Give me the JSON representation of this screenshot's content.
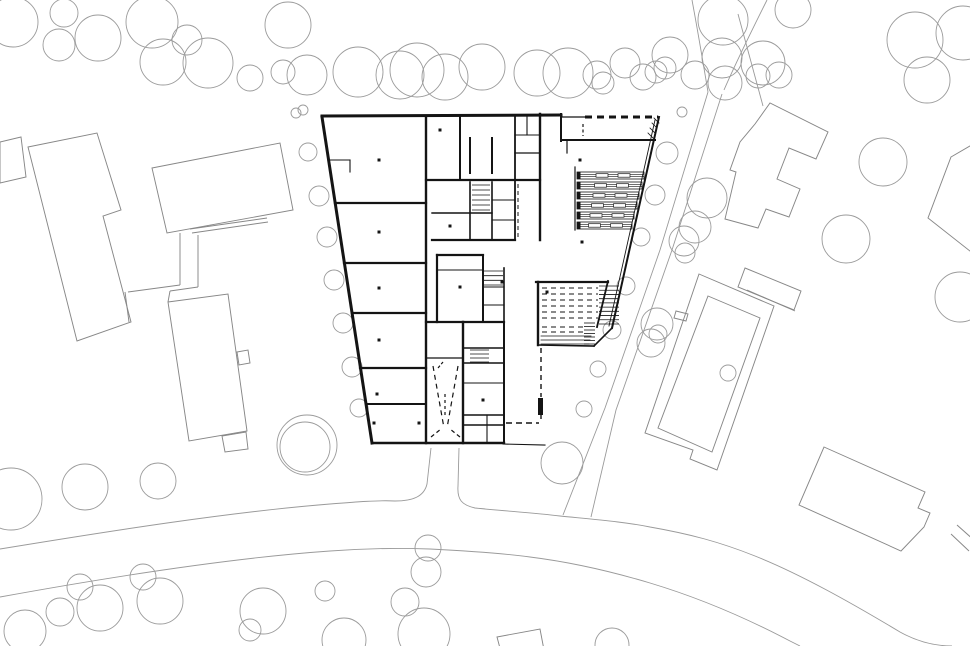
{
  "canvas": {
    "w": 970,
    "h": 646,
    "bg": "#ffffff"
  },
  "style": {
    "tree_stroke": "#9b9b9b",
    "tree_width": 0.9,
    "context_stroke": "#878787",
    "context_width": 0.95,
    "road_stroke": "#9a9a9a",
    "road_width": 0.9,
    "wall_color": "#141414"
  },
  "trees": [
    [
      13,
      22,
      25
    ],
    [
      64,
      13,
      14
    ],
    [
      59,
      45,
      16
    ],
    [
      98,
      38,
      23
    ],
    [
      152,
      22,
      26
    ],
    [
      163,
      62,
      23
    ],
    [
      187,
      40,
      15
    ],
    [
      208,
      63,
      25
    ],
    [
      250,
      78,
      13
    ],
    [
      288,
      25,
      23
    ],
    [
      283,
      72,
      12
    ],
    [
      307,
      75,
      20
    ],
    [
      303,
      110,
      5
    ],
    [
      358,
      72,
      25
    ],
    [
      400,
      75,
      24
    ],
    [
      417,
      70,
      27
    ],
    [
      445,
      77,
      23
    ],
    [
      482,
      67,
      23
    ],
    [
      537,
      73,
      23
    ],
    [
      568,
      73,
      25
    ],
    [
      597,
      75,
      14
    ],
    [
      603,
      83,
      11
    ],
    [
      625,
      63,
      15
    ],
    [
      643,
      77,
      13
    ],
    [
      656,
      72,
      11
    ],
    [
      670,
      55,
      18
    ],
    [
      665,
      68,
      11
    ],
    [
      695,
      75,
      14
    ],
    [
      723,
      20,
      25
    ],
    [
      722,
      58,
      20
    ],
    [
      725,
      83,
      17
    ],
    [
      763,
      63,
      22
    ],
    [
      758,
      76,
      12
    ],
    [
      779,
      75,
      13
    ],
    [
      793,
      10,
      18
    ],
    [
      682,
      112,
      5
    ],
    [
      915,
      40,
      28
    ],
    [
      963,
      33,
      27
    ],
    [
      927,
      80,
      23
    ],
    [
      296,
      113,
      5
    ],
    [
      308,
      152,
      9
    ],
    [
      319,
      196,
      10
    ],
    [
      327,
      237,
      10
    ],
    [
      334,
      280,
      10
    ],
    [
      343,
      323,
      10
    ],
    [
      352,
      367,
      10
    ],
    [
      359,
      408,
      9
    ],
    [
      307,
      445,
      30
    ],
    [
      667,
      153,
      11
    ],
    [
      655,
      195,
      10
    ],
    [
      641,
      237,
      9
    ],
    [
      626,
      286,
      9
    ],
    [
      612,
      330,
      9
    ],
    [
      598,
      369,
      8
    ],
    [
      584,
      409,
      8
    ],
    [
      707,
      198,
      20
    ],
    [
      695,
      227,
      16
    ],
    [
      684,
      241,
      15
    ],
    [
      685,
      253,
      10
    ],
    [
      657,
      324,
      16
    ],
    [
      651,
      343,
      14
    ],
    [
      658,
      334,
      9
    ],
    [
      728,
      373,
      8
    ],
    [
      883,
      162,
      24
    ],
    [
      846,
      239,
      24
    ],
    [
      960,
      297,
      25
    ],
    [
      11,
      499,
      31
    ],
    [
      85,
      487,
      23
    ],
    [
      158,
      481,
      18
    ],
    [
      305,
      447,
      25
    ],
    [
      562,
      463,
      21
    ],
    [
      428,
      548,
      13
    ],
    [
      426,
      572,
      15
    ],
    [
      405,
      602,
      14
    ],
    [
      424,
      634,
      26
    ],
    [
      344,
      640,
      22
    ],
    [
      80,
      587,
      13
    ],
    [
      60,
      612,
      14
    ],
    [
      100,
      608,
      23
    ],
    [
      143,
      577,
      13
    ],
    [
      160,
      601,
      23
    ],
    [
      25,
      631,
      21
    ],
    [
      263,
      611,
      23
    ],
    [
      250,
      630,
      11
    ],
    [
      325,
      591,
      10
    ],
    [
      612,
      645,
      17
    ]
  ],
  "context": {
    "polygons": [
      {
        "name": "west-slab",
        "pts": [
          [
            28,
            147
          ],
          [
            97,
            133
          ],
          [
            121,
            210
          ],
          [
            103,
            216
          ],
          [
            131,
            322
          ],
          [
            77,
            341
          ]
        ]
      },
      {
        "name": "west-annex",
        "pts": [
          [
            0,
            142
          ],
          [
            21,
            137
          ],
          [
            26,
            177
          ],
          [
            0,
            183
          ]
        ]
      },
      {
        "name": "northwest-rect",
        "pts": [
          [
            152,
            168
          ],
          [
            280,
            143
          ],
          [
            293,
            210
          ],
          [
            167,
            233
          ]
        ]
      },
      {
        "name": "west-house",
        "pts": [
          [
            168,
            302
          ],
          [
            228,
            294
          ],
          [
            247,
            431
          ],
          [
            189,
            441
          ]
        ]
      },
      {
        "name": "west-house-tab",
        "pts": [
          [
            222,
            436
          ],
          [
            246,
            432
          ],
          [
            248,
            449
          ],
          [
            225,
            452
          ]
        ]
      },
      {
        "name": "west-house-side-tab",
        "pts": [
          [
            237,
            352
          ],
          [
            248,
            350
          ],
          [
            250,
            363
          ],
          [
            239,
            365
          ]
        ]
      },
      {
        "name": "northeast-f-building",
        "pts": [
          [
            755,
            124
          ],
          [
            770,
            103
          ],
          [
            828,
            132
          ],
          [
            816,
            159
          ],
          [
            789,
            148
          ],
          [
            777,
            179
          ],
          [
            800,
            189
          ],
          [
            789,
            217
          ],
          [
            766,
            209
          ],
          [
            758,
            228
          ],
          [
            725,
            219
          ],
          [
            736,
            172
          ],
          [
            730,
            170
          ],
          [
            740,
            142
          ]
        ]
      },
      {
        "name": "east-diamond",
        "pts": [
          [
            951,
            157
          ],
          [
            975,
            143
          ],
          [
            975,
            255
          ],
          [
            928,
            218
          ]
        ]
      },
      {
        "name": "east-hall-outer",
        "pts": [
          [
            699,
            274
          ],
          [
            774,
            306
          ],
          [
            717,
            470
          ],
          [
            690,
            459
          ],
          [
            693,
            450
          ],
          [
            645,
            433
          ]
        ]
      },
      {
        "name": "east-hall-inner",
        "pts": [
          [
            708,
            296
          ],
          [
            760,
            318
          ],
          [
            712,
            452
          ],
          [
            658,
            428
          ]
        ]
      },
      {
        "name": "east-hall-top-rect",
        "pts": [
          [
            745,
            268
          ],
          [
            801,
            291
          ],
          [
            794,
            310
          ],
          [
            738,
            287
          ]
        ]
      },
      {
        "name": "east-hall-tab",
        "pts": [
          [
            676,
            311
          ],
          [
            688,
            314
          ],
          [
            686,
            321
          ],
          [
            674,
            318
          ]
        ]
      },
      {
        "name": "southeast-rect",
        "pts": [
          [
            824,
            447
          ],
          [
            925,
            492
          ],
          [
            918,
            508
          ],
          [
            930,
            513
          ],
          [
            924,
            527
          ],
          [
            901,
            551
          ],
          [
            799,
            505
          ]
        ]
      },
      {
        "name": "south-partial-square",
        "pts": [
          [
            497,
            637
          ],
          [
            540,
            629
          ],
          [
            544,
            650
          ],
          [
            501,
            652
          ]
        ]
      }
    ],
    "lines": [
      [
        190,
        229,
        267,
        218
      ],
      [
        192,
        233,
        268,
        222
      ],
      [
        180,
        233,
        180,
        285
      ],
      [
        198,
        235,
        198,
        287
      ],
      [
        180,
        285,
        128,
        292
      ],
      [
        125,
        292,
        129,
        322
      ],
      [
        198,
        287,
        170,
        291
      ],
      [
        170,
        291,
        168,
        302
      ],
      [
        747,
        290,
        795,
        311
      ],
      [
        957,
        525,
        975,
        541
      ],
      [
        951,
        534,
        969,
        551
      ]
    ]
  },
  "roads": {
    "paths": [
      "M 0,549 C 110,531 230,512 330,504 C 355,502 380,500 395,501 C 412,501 424,497 427,484 L 431,448",
      "M 459,448 L 458,486 C 457,500 462,505 475,508 C 505,511 535,513 560,516 C 600,520 625,522 650,527 C 690,534 720,542 755,556 C 800,574 850,602 900,632 C 918,642 935,646 952,646",
      "M 0,597 C 110,577 230,558 330,551 C 370,548 400,548 430,549 C 470,551 500,553 530,557 C 570,562 610,571 650,583 C 700,598 750,620 790,641 L 800,646",
      "M 692,0 C 698,32 703,62 708,92",
      "M 708,92 L 660,250 L 605,408 L 563,515",
      "M 722,94 L 672,250 L 616,410 L 591,517",
      "M 767,0 C 753,28 737,60 724,90",
      "M 738,14 L 763,106"
    ]
  },
  "building": {
    "walls": [
      [
        322,
        116,
        561,
        115,
        3
      ],
      [
        561,
        114,
        561,
        141,
        2
      ],
      [
        561,
        117,
        585,
        117,
        1.2
      ],
      [
        322,
        117,
        372,
        443,
        3
      ],
      [
        372,
        443,
        504,
        443,
        2.4
      ],
      [
        659,
        117,
        612,
        328,
        2
      ],
      [
        655,
        120,
        609,
        326,
        0.9
      ],
      [
        426,
        117,
        426,
        443,
        2.4
      ],
      [
        335,
        203,
        426,
        203,
        2.2
      ],
      [
        344,
        263,
        426,
        263,
        2.2
      ],
      [
        352,
        313,
        426,
        313,
        2.2
      ],
      [
        360,
        368,
        426,
        368,
        2.2
      ],
      [
        366,
        404,
        426,
        404,
        2
      ],
      [
        328,
        160,
        350,
        160,
        1.1
      ],
      [
        350,
        160,
        350,
        172,
        1.1
      ],
      [
        460,
        117,
        460,
        180,
        2
      ],
      [
        426,
        180,
        540,
        180,
        2.2
      ],
      [
        470,
        138,
        470,
        173,
        2
      ],
      [
        492,
        138,
        492,
        173,
        2
      ],
      [
        515,
        117,
        515,
        180,
        1.8
      ],
      [
        527,
        117,
        527,
        135,
        1.1
      ],
      [
        515,
        135,
        540,
        135,
        1.1
      ],
      [
        515,
        153,
        540,
        153,
        1.3
      ],
      [
        540,
        114,
        540,
        240,
        2.4
      ],
      [
        561,
        140,
        655,
        140,
        2
      ],
      [
        567,
        140,
        567,
        153,
        1.2
      ],
      [
        575,
        167,
        575,
        230,
        1.2
      ],
      [
        432,
        240,
        515,
        240,
        2.2
      ],
      [
        470,
        182,
        470,
        240,
        1.6
      ],
      [
        492,
        182,
        492,
        240,
        1.6
      ],
      [
        515,
        180,
        515,
        240,
        1.8
      ],
      [
        432,
        213,
        492,
        213,
        1.4
      ],
      [
        492,
        200,
        515,
        200,
        1.1
      ],
      [
        492,
        220,
        515,
        220,
        1.1
      ],
      [
        437,
        255,
        483,
        255,
        2.2
      ],
      [
        437,
        255,
        437,
        322,
        2.2
      ],
      [
        483,
        255,
        483,
        322,
        2
      ],
      [
        426,
        322,
        504,
        322,
        2.2
      ],
      [
        437,
        270,
        483,
        270,
        1.1
      ],
      [
        504,
        268,
        504,
        322,
        1.6
      ],
      [
        483,
        287,
        504,
        287,
        1.1
      ],
      [
        483,
        305,
        504,
        305,
        1.1
      ],
      [
        463,
        322,
        463,
        443,
        2.4
      ],
      [
        504,
        322,
        504,
        443,
        2
      ],
      [
        463,
        348,
        504,
        348,
        1.4
      ],
      [
        463,
        363,
        504,
        363,
        1.4
      ],
      [
        463,
        383,
        504,
        383,
        1.1
      ],
      [
        463,
        415,
        504,
        415,
        1.4
      ],
      [
        463,
        425,
        504,
        425,
        1.6
      ],
      [
        487,
        415,
        487,
        443,
        1.1
      ],
      [
        426,
        358,
        463,
        358,
        1.3
      ],
      [
        536,
        282,
        608,
        282,
        2.2
      ],
      [
        538,
        282,
        538,
        345,
        2.4
      ],
      [
        608,
        281,
        597,
        327,
        1.8
      ],
      [
        612,
        328,
        594,
        346,
        1.6
      ],
      [
        538,
        345,
        594,
        346,
        1.6
      ],
      [
        503,
        444,
        545,
        445,
        1.1
      ],
      [
        541,
        336,
        591,
        336,
        0.8
      ],
      [
        541,
        340,
        590,
        340,
        0.8
      ],
      [
        541,
        344,
        589,
        344,
        0.8
      ],
      [
        654,
        118,
        659,
        123,
        0.8
      ],
      [
        652,
        123,
        657,
        128,
        0.8
      ],
      [
        650,
        128,
        655,
        133,
        0.8
      ],
      [
        648,
        133,
        653,
        138,
        0.8
      ]
    ],
    "dashed": [
      [
        585,
        117,
        658,
        117,
        3,
        7,
        5
      ],
      [
        583,
        124,
        583,
        136,
        1.2,
        3,
        2.5
      ],
      [
        542,
        288,
        598,
        288,
        1,
        5,
        4
      ],
      [
        542,
        294,
        598,
        294,
        1,
        5,
        4
      ],
      [
        542,
        300,
        598,
        300,
        1,
        5,
        4
      ],
      [
        542,
        306,
        598,
        306,
        1,
        5,
        4
      ],
      [
        542,
        312,
        598,
        312,
        1,
        5,
        4
      ],
      [
        542,
        318,
        598,
        318,
        1,
        5,
        4
      ],
      [
        542,
        327,
        583,
        327,
        1,
        5,
        4
      ],
      [
        542,
        332,
        583,
        332,
        1,
        5,
        4
      ],
      [
        541,
        348,
        541,
        397,
        1.4,
        5,
        4
      ],
      [
        541,
        415,
        541,
        422,
        1.4,
        4,
        3
      ],
      [
        506,
        423,
        539,
        423,
        1.6,
        6,
        4
      ],
      [
        518,
        184,
        518,
        238,
        1,
        4,
        3
      ],
      [
        433,
        366,
        444,
        428,
        1.2,
        5,
        4
      ],
      [
        458,
        366,
        447,
        428,
        1.2,
        5,
        4
      ],
      [
        445,
        394,
        445,
        416,
        1.2,
        3,
        3
      ],
      [
        431,
        437,
        441,
        429,
        1.2,
        4,
        3
      ],
      [
        460,
        437,
        450,
        429,
        1.2,
        4,
        3
      ],
      [
        438,
        368,
        443,
        362,
        1.2,
        3,
        2
      ]
    ],
    "posts": [
      [
        538,
        398,
        5,
        17
      ]
    ],
    "dots": [
      [
        379,
        160
      ],
      [
        379,
        232
      ],
      [
        379,
        288
      ],
      [
        379,
        340
      ],
      [
        377,
        394
      ],
      [
        374,
        423
      ],
      [
        419,
        423
      ],
      [
        440,
        130
      ],
      [
        450,
        226
      ],
      [
        460,
        287
      ],
      [
        483,
        400
      ],
      [
        502,
        282
      ],
      [
        547,
        292
      ],
      [
        580,
        160
      ],
      [
        582,
        242
      ]
    ],
    "hatches": [
      {
        "x": 472,
        "y": 185,
        "w": 18,
        "h": 25,
        "n": 6
      },
      {
        "x": 484,
        "y": 271,
        "w": 19,
        "h": 14,
        "n": 4
      },
      {
        "x": 470,
        "y": 350,
        "w": 19,
        "h": 12,
        "n": 4
      },
      {
        "x": 599,
        "y": 286,
        "w": 20,
        "h": 38,
        "n": 10
      },
      {
        "x": 584,
        "y": 323,
        "w": 11,
        "h": 21,
        "n": 7
      }
    ],
    "bands": {
      "x1": 577,
      "h": 7,
      "cap_w": 3.5,
      "ys": [
        172,
        182,
        192,
        202,
        212,
        222
      ],
      "x2s": [
        644,
        642,
        639,
        637,
        634,
        632
      ],
      "tick_xs": [
        596,
        618
      ],
      "tick_w": 12,
      "tick_h": 3.5
    }
  }
}
